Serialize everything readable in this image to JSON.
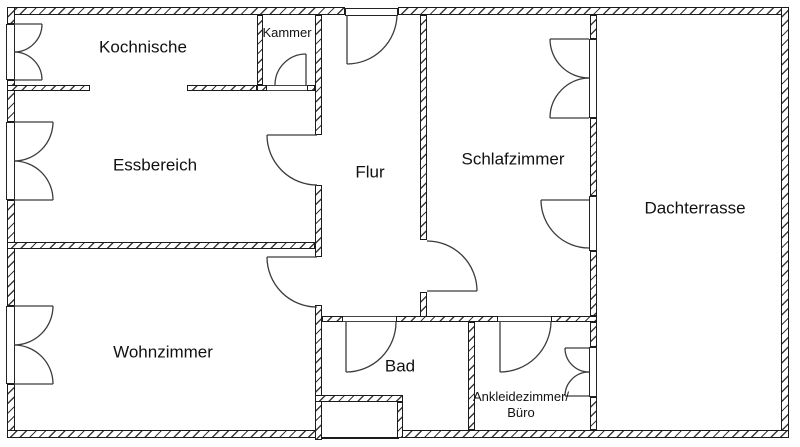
{
  "plan": {
    "rooms": [
      {
        "id": "kochnische",
        "label": "Kochnische"
      },
      {
        "id": "kammer",
        "label": "Kammer"
      },
      {
        "id": "essbereich",
        "label": "Essbereich"
      },
      {
        "id": "flur",
        "label": "Flur"
      },
      {
        "id": "schlafzimmer",
        "label": "Schlafzimmer"
      },
      {
        "id": "dachterrasse",
        "label": "Dachterrasse"
      },
      {
        "id": "wohnzimmer",
        "label": "Wohnzimmer"
      },
      {
        "id": "bad",
        "label": "Bad"
      },
      {
        "id": "ankleidezimmer",
        "label": "Ankleidezimmer/",
        "label_line2": "Büro"
      }
    ],
    "colors": {
      "background": "#ffffff",
      "wall_line": "#1b1b1b",
      "hatch": "#3a3a3a",
      "text": "#111111"
    }
  }
}
